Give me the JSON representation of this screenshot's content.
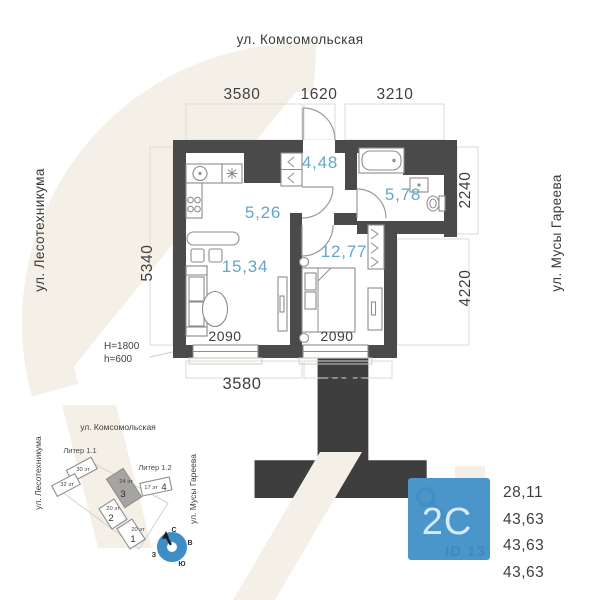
{
  "floor_plan": {
    "streets": {
      "top": "ул. Комсомольская",
      "left": "ул. Лесотехникума",
      "right": "ул. Мусы Гареева"
    },
    "dimensions": {
      "top": [
        "3580",
        "1620",
        "3210"
      ],
      "left": "5340",
      "right": [
        "2240",
        "4220"
      ],
      "bottom": [
        "3580",
        "2950"
      ],
      "windows": [
        "2090",
        "2090"
      ],
      "window_notes": [
        "H=1800",
        "h=600"
      ]
    },
    "room_areas": {
      "hall": "4,48",
      "kitchen": "5,26",
      "bathroom": "5,78",
      "bedroom": "12,77",
      "living": "15,34"
    }
  },
  "site_plan": {
    "streets": {
      "top": "ул. Комсомольская",
      "left": "ул. Лесотехникума",
      "right": "ул. Мусы Гареева"
    },
    "blocks": [
      "Литер 1.1",
      "Литер 1.2"
    ],
    "buildings": [
      {
        "floors": "30 эт",
        "num": ""
      },
      {
        "floors": "32 эт",
        "num": ""
      },
      {
        "floors": "24 эт",
        "num": "3"
      },
      {
        "floors": "17 эт",
        "num": "4"
      },
      {
        "floors": "20 эт",
        "num": "2"
      },
      {
        "floors": "20 эт",
        "num": "1"
      }
    ],
    "compass": {
      "n": "С",
      "e": "В",
      "s": "Ю",
      "w": "З"
    }
  },
  "info_card": {
    "plan_type": "2С",
    "watermark": "ID 13",
    "areas": [
      "28,11",
      "43,63",
      "43,63",
      "43,63"
    ]
  },
  "colors": {
    "wall": "#4a4a4a",
    "accent_blue": "#4a96cb",
    "room_label_blue": "#63a6cc",
    "watermark_beige": "#f5f0e7"
  }
}
